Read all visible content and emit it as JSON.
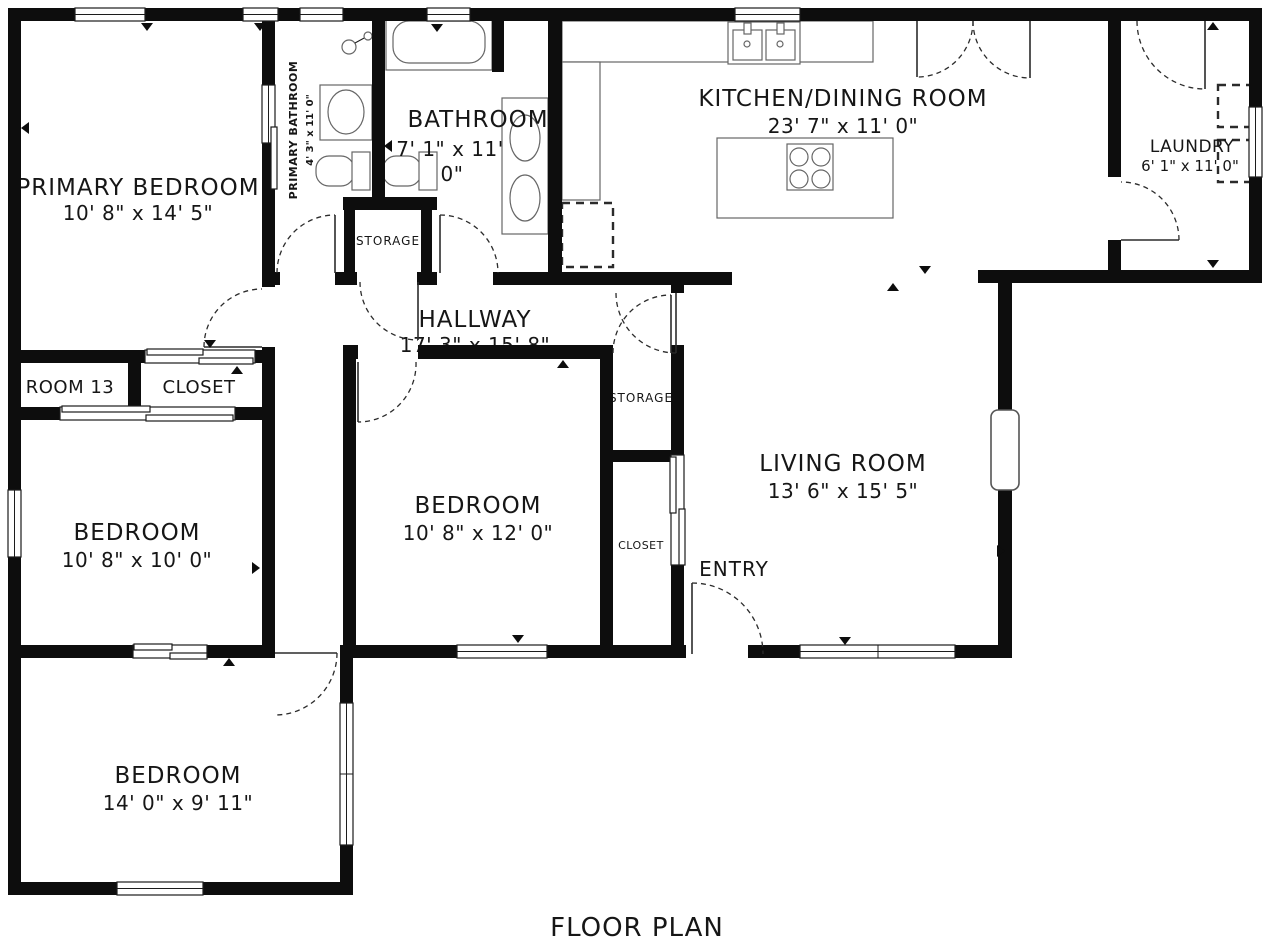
{
  "title": "FLOOR PLAN",
  "colors": {
    "wall": "#0d0d0d",
    "fixture": "#555555",
    "text": "#161616",
    "background": "#ffffff"
  },
  "rooms": {
    "primary_bedroom": {
      "name": "PRIMARY BEDROOM",
      "dims": "10' 8\" x 14' 5\""
    },
    "primary_bathroom": {
      "name": "PRIMARY BATHROOM",
      "dims": "4' 3\" x 11' 0\""
    },
    "bathroom": {
      "name": "BATHROOM",
      "dims_line1": "7' 1\" x 11'",
      "dims_line2": "0\""
    },
    "kitchen_dining": {
      "name": "KITCHEN/DINING ROOM",
      "dims": "23' 7\" x 11' 0\""
    },
    "laundry": {
      "name": "LAUNDRY",
      "dims": "6' 1\" x 11' 0\""
    },
    "hallway": {
      "name": "HALLWAY",
      "dims": "17' 3\" x 15' 8\""
    },
    "room13": {
      "name": "ROOM 13"
    },
    "closet_primary": {
      "name": "CLOSET"
    },
    "storage_hall": {
      "name": "STORAGE"
    },
    "storage_living": {
      "name": "STORAGE"
    },
    "closet_entry": {
      "name": "CLOSET"
    },
    "bedroom_left": {
      "name": "BEDROOM",
      "dims": "10' 8\" x 10' 0\""
    },
    "bedroom_center": {
      "name": "BEDROOM",
      "dims": "10' 8\" x 12' 0\""
    },
    "living_room": {
      "name": "LIVING ROOM",
      "dims": "13' 6\" x 15' 5\""
    },
    "entry": {
      "name": "ENTRY"
    },
    "bedroom_bottom": {
      "name": "BEDROOM",
      "dims": "14' 0\" x 9' 11\""
    }
  }
}
